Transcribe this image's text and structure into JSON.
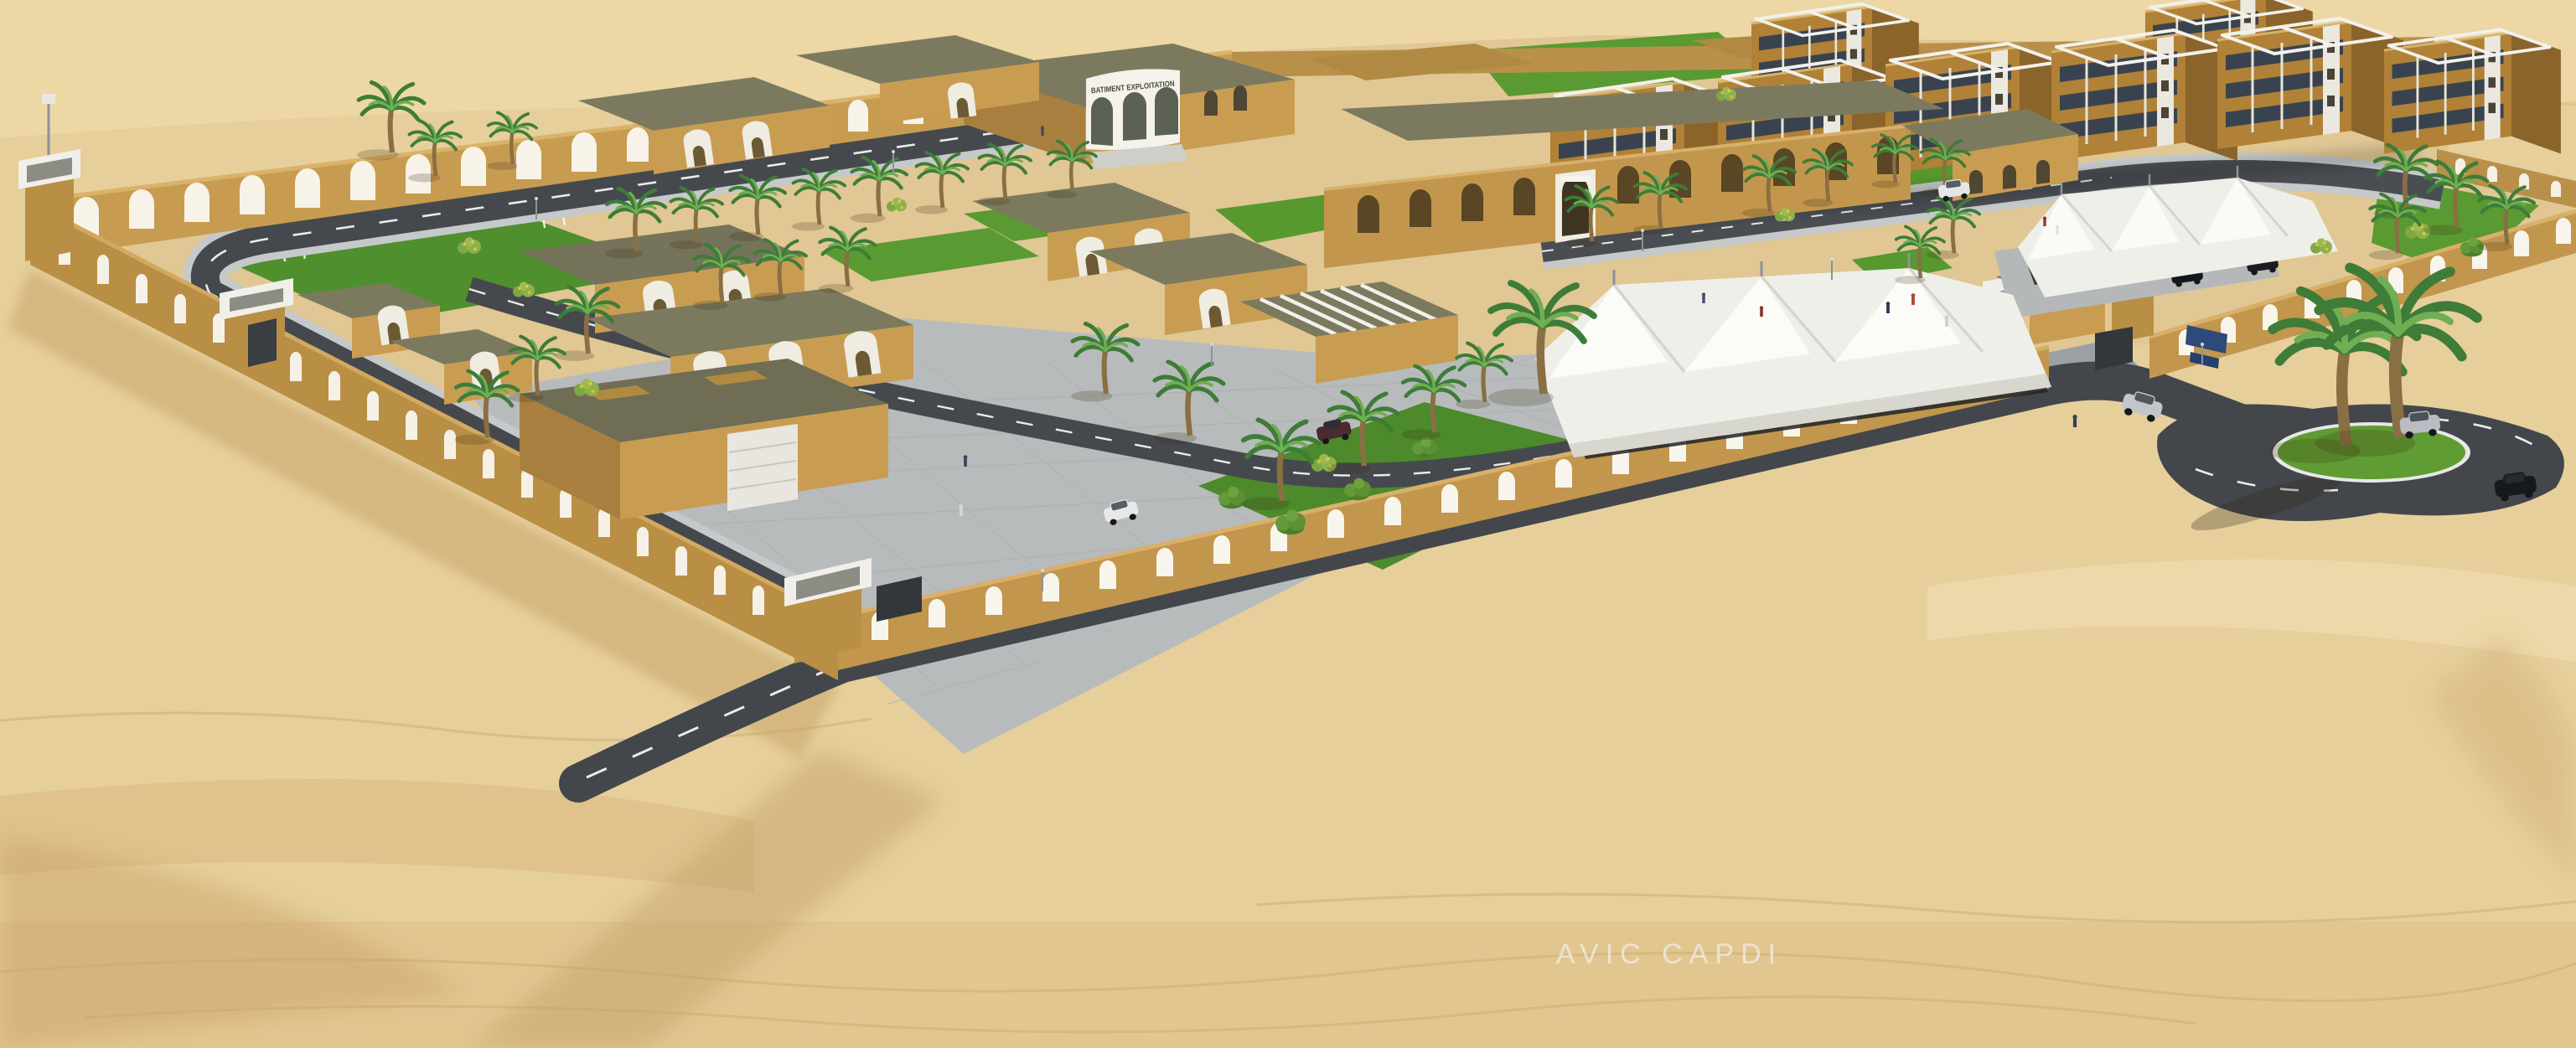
{
  "scene": {
    "type": "3d-architectural-rendering",
    "description": "Aerial perspective rendering of a walled desert compound: arched sand-coloured perimeter walls, flat-roofed buildings, apartment blocks, white tensile shade canopies, palm trees, internal roads, an entrance gate and a roundabout surrounded by open dunes."
  },
  "signs": {
    "operations_building": "BATIMENT EXPLOITATION",
    "gate_reception": "ACCUEIL"
  },
  "watermark": "AVIC CAPDI",
  "palette": {
    "sand": "#e6cf9b",
    "sand_light": "#f0e0b4",
    "sand_shadow": "#c9a368",
    "wall_tan": "#c2964c",
    "building_tan": "#c89d52",
    "roof_olive": "#7c7a5e",
    "lawn_green": "#5f9c33",
    "road_asphalt": "#43474c",
    "paving_gray": "#b7bbbc",
    "canopy_white": "#efefe9",
    "marking_white": "#e9ecec"
  }
}
